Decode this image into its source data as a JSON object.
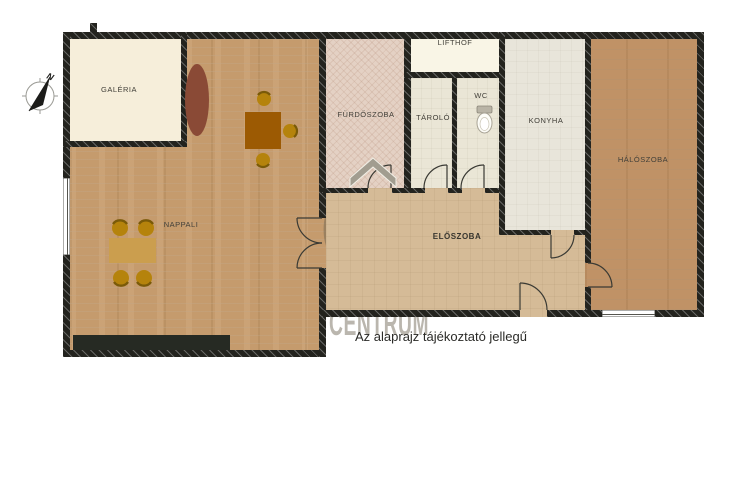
{
  "plan": {
    "disclaimer": "Az alaprajz tájékoztató jellegű",
    "compass": {
      "north_label": "N"
    },
    "watermark": {
      "line1": "OC",
      "line2": "OTTHON",
      "line3": "CENTRUM"
    },
    "rooms": [
      {
        "id": "galeria",
        "label": "GALÉRIA"
      },
      {
        "id": "nappali",
        "label": "NAPPALI"
      },
      {
        "id": "furdoszoba",
        "label": "FÜRDŐSZOBA"
      },
      {
        "id": "tarolo",
        "label": "TÁROLÓ"
      },
      {
        "id": "wc",
        "label": "WC"
      },
      {
        "id": "lifthof",
        "label": "LIFTHOF"
      },
      {
        "id": "konyha",
        "label": "KONYHA"
      },
      {
        "id": "haloszoba",
        "label": "HÁLÓSZOBA"
      },
      {
        "id": "eloszoba",
        "label": "ELŐSZOBA"
      }
    ],
    "colors": {
      "wall": "#23231e",
      "wood_living": "#c59b6d",
      "wood_bedroom": "#c09266",
      "hall_floor": "#d5bb97",
      "bath_tile": "#e4d1c4",
      "cream_floor": "#f6eeda",
      "furniture_brown": "#9c5a03",
      "chair_gold": "#b5830c",
      "sofa_dark": "#262a23",
      "watermark_gray": "#685f4e"
    }
  }
}
